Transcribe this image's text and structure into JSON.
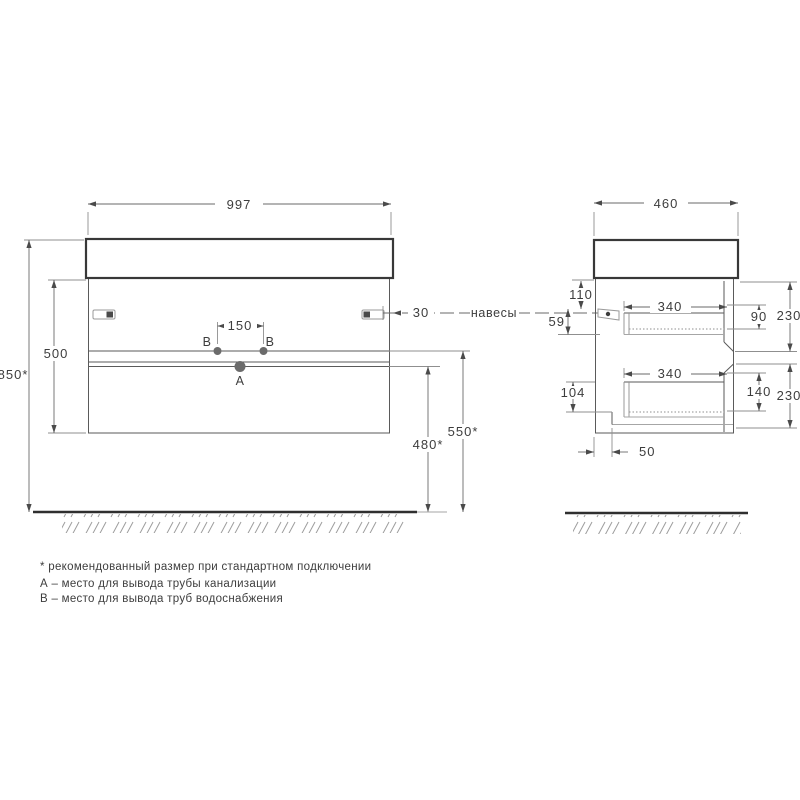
{
  "drawing": {
    "front_view": {
      "width": "997",
      "body_height": "500",
      "total_height": "850*",
      "hanger_offset": "30",
      "outlet_spacing": "150",
      "water_outlet_height": "550*",
      "drain_outlet_height": "480*",
      "point_a": "A",
      "point_b1": "B",
      "point_b2": "B"
    },
    "side_view": {
      "depth": "460",
      "hanger_from_top": "110",
      "hanger_to_drawer": "59",
      "top_drawer_depth": "340",
      "top_drawer_inner_height": "90",
      "top_front_height": "230",
      "between_drawers": "104",
      "bottom_drawer_depth": "340",
      "bottom_drawer_inner_height": "140",
      "bottom_front_height": "230",
      "pipe_recess_depth": "50"
    },
    "labels": {
      "hangers": "навесы"
    },
    "footnotes": [
      "* рекомендованный размер при стандартном подключении",
      "А – место для вывода трубы канализации",
      "B – место для вывода труб водоснабжения"
    ],
    "colors": {
      "line": "#3d3d3d",
      "light_line": "#9e9e9e",
      "text": "#3d3d3d",
      "background": "#ffffff"
    }
  }
}
